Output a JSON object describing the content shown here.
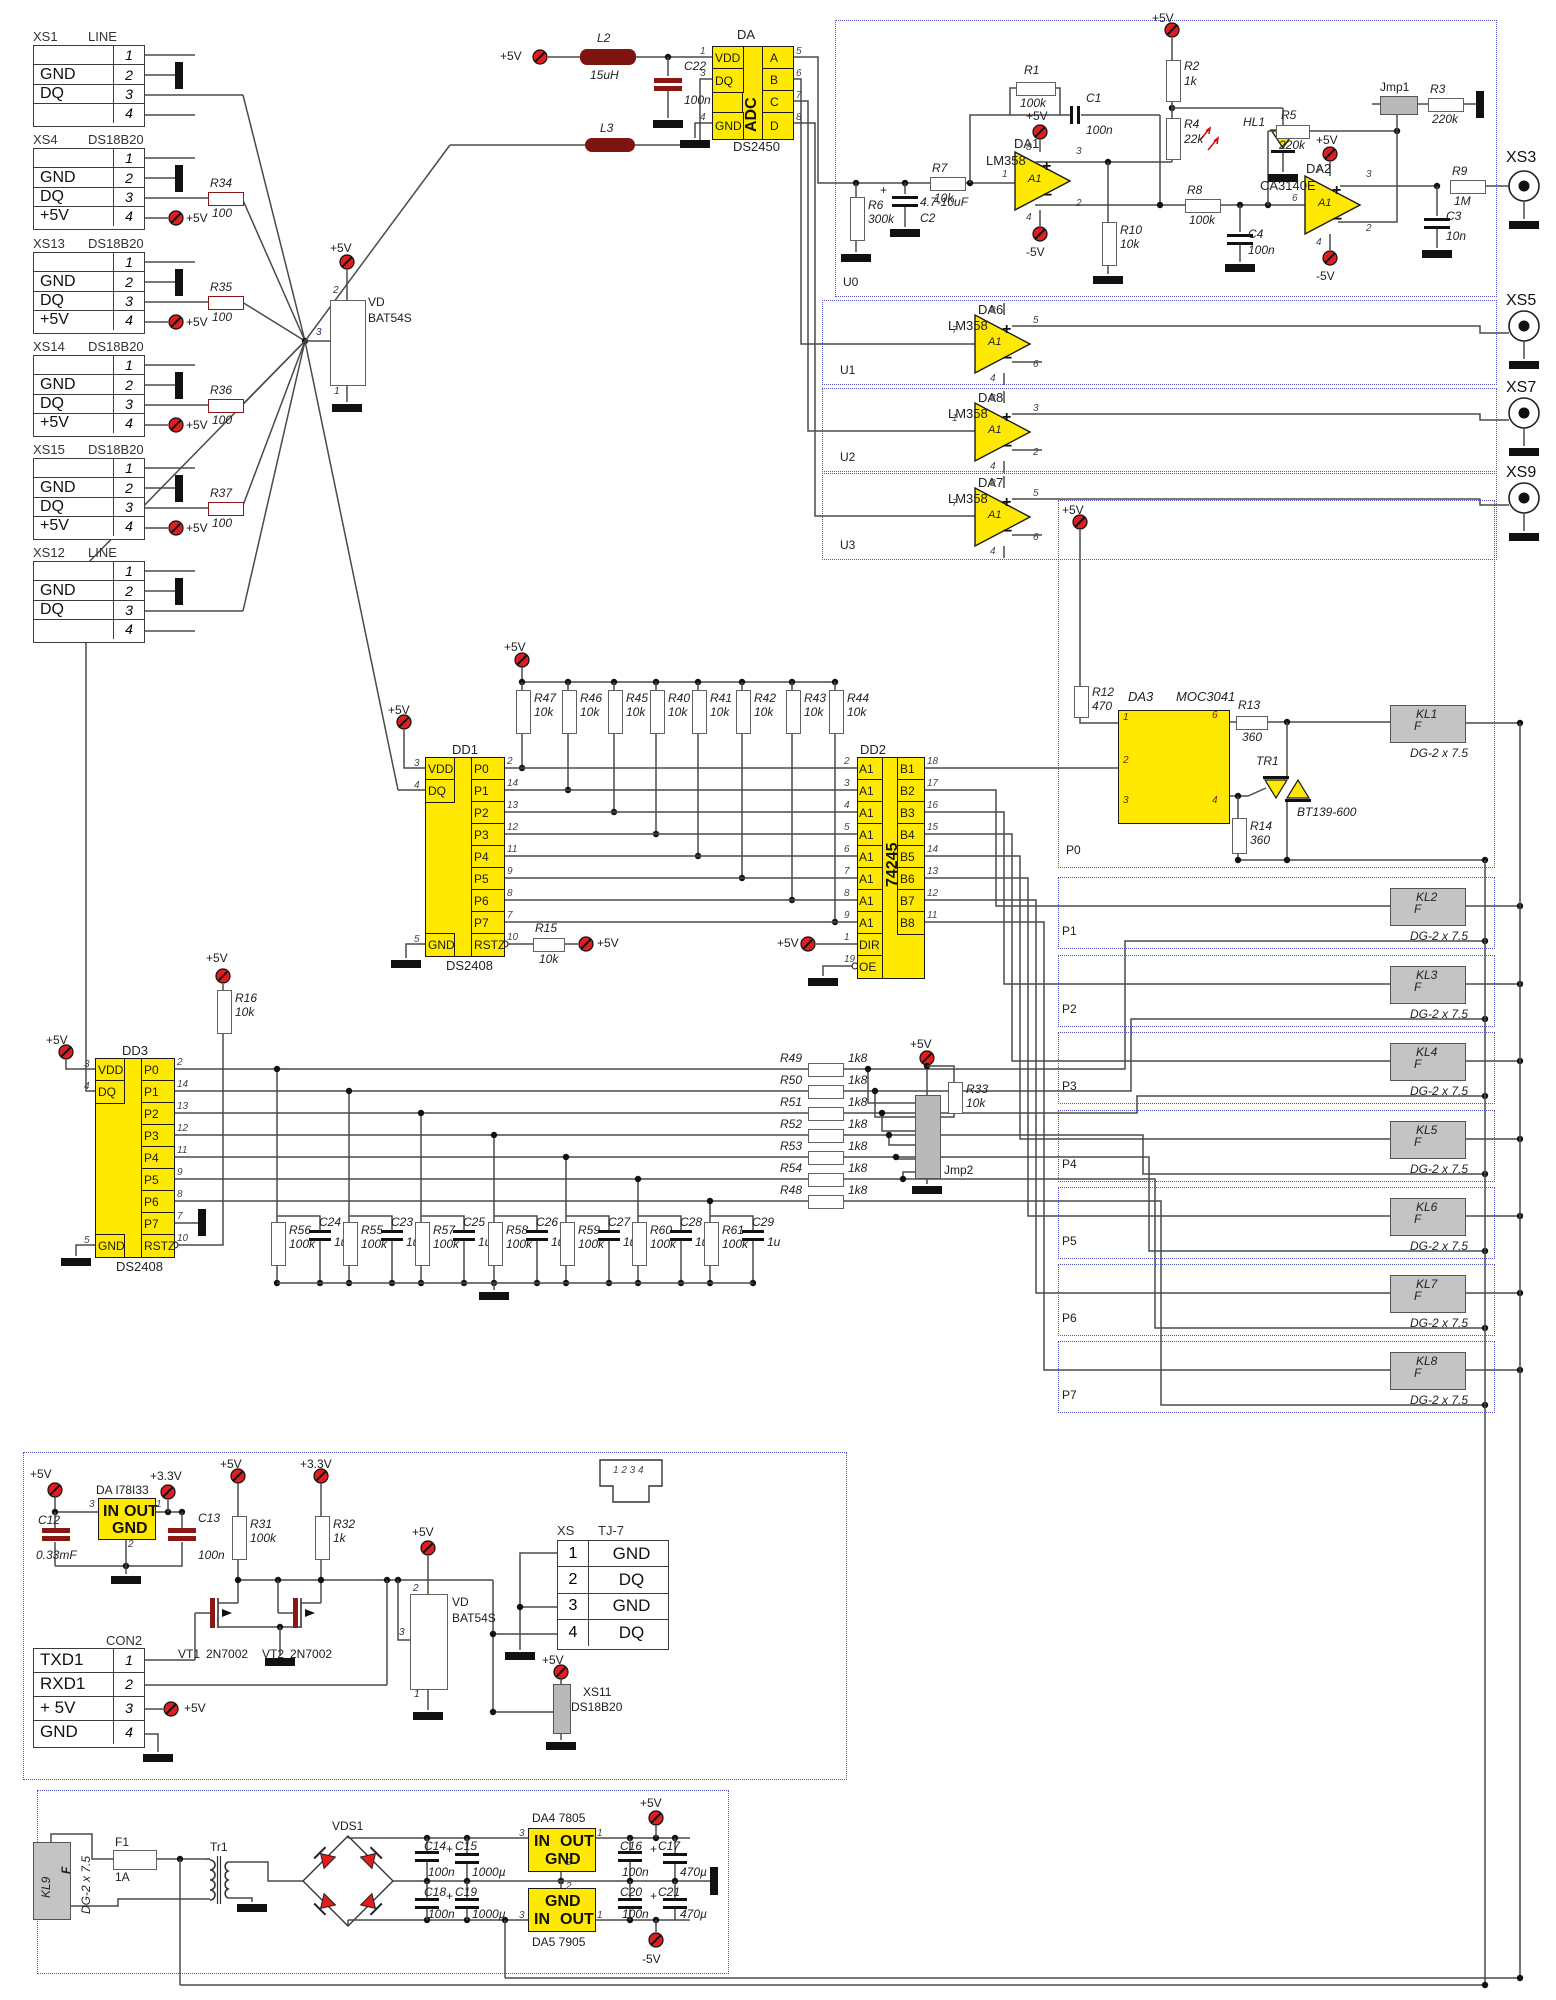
{
  "rails": {
    "p5": "+5V",
    "m5": "-5V",
    "p33": "+3.3V"
  },
  "plus": "+",
  "left_connectors": [
    {
      "title": "XS1",
      "sub": "LINE",
      "rows": [
        {
          "l": "",
          "p": "1"
        },
        {
          "l": "GND",
          "p": "2"
        },
        {
          "l": "DQ",
          "p": "3"
        },
        {
          "l": "",
          "p": "4"
        }
      ],
      "res": null
    },
    {
      "title": "XS4",
      "sub": "DS18B20",
      "rows": [
        {
          "l": "",
          "p": "1"
        },
        {
          "l": "GND",
          "p": "2"
        },
        {
          "l": "DQ",
          "p": "3"
        },
        {
          "l": "+5V",
          "p": "4"
        }
      ],
      "res": [
        "R34",
        "100"
      ]
    },
    {
      "title": "XS13",
      "sub": "DS18B20",
      "rows": [
        {
          "l": "",
          "p": "1"
        },
        {
          "l": "GND",
          "p": "2"
        },
        {
          "l": "DQ",
          "p": "3"
        },
        {
          "l": "+5V",
          "p": "4"
        }
      ],
      "res": [
        "R35",
        "100"
      ]
    },
    {
      "title": "XS14",
      "sub": "DS18B20",
      "rows": [
        {
          "l": "",
          "p": "1"
        },
        {
          "l": "GND",
          "p": "2"
        },
        {
          "l": "DQ",
          "p": "3"
        },
        {
          "l": "+5V",
          "p": "4"
        }
      ],
      "res": [
        "R36",
        "100"
      ]
    },
    {
      "title": "XS15",
      "sub": "DS18B20",
      "rows": [
        {
          "l": "",
          "p": "1"
        },
        {
          "l": "GND",
          "p": "2"
        },
        {
          "l": "DQ",
          "p": "3"
        },
        {
          "l": "+5V",
          "p": "4"
        }
      ],
      "res": [
        "R37",
        "100"
      ]
    },
    {
      "title": "XS12",
      "sub": "LINE",
      "rows": [
        {
          "l": "",
          "p": "1"
        },
        {
          "l": "GND",
          "p": "2"
        },
        {
          "l": "DQ",
          "p": "3"
        },
        {
          "l": "",
          "p": "4"
        }
      ],
      "res": null
    }
  ],
  "vd1": {
    "des": "VD",
    "part": "BAT54S",
    "p_top": "2",
    "p_mid": "3",
    "p_bot": "1"
  },
  "filter": {
    "l2": [
      "L2",
      "15uH"
    ],
    "c22": [
      "C22",
      "100n"
    ],
    "l3": [
      "L3"
    ]
  },
  "adc": {
    "title": "DA",
    "part": "DS2450",
    "core": "ADC",
    "left": [
      {
        "n": "VDD",
        "p": "1"
      },
      {
        "n": "DQ",
        "p": "3"
      },
      {
        "n": "GND",
        "p": "4"
      }
    ],
    "right": [
      {
        "n": "A",
        "p": "5"
      },
      {
        "n": "B",
        "p": "6"
      },
      {
        "n": "C",
        "p": "7"
      },
      {
        "n": "D",
        "p": "8"
      }
    ]
  },
  "u0": {
    "tag": "U0",
    "r6": [
      "R6",
      "300k"
    ],
    "c2": [
      "C2",
      "4.7-10uF"
    ],
    "r7": [
      "R7",
      "10k"
    ],
    "r1": [
      "R1",
      "100k"
    ],
    "c1": [
      "C1",
      "100n"
    ],
    "r2": [
      "R2",
      "1k"
    ],
    "r4": [
      "R4",
      "22k"
    ],
    "hl1": "HL1",
    "r10": [
      "R10",
      "10k"
    ],
    "r8": [
      "R8",
      "100k"
    ],
    "c4": [
      "C4",
      "100n"
    ],
    "r5": [
      "R5",
      "220k"
    ],
    "jmp1": "Jmp1",
    "r3": [
      "R3",
      "220k"
    ],
    "r9": [
      "R9",
      "1M"
    ],
    "c3": [
      "C3",
      "10n"
    ],
    "da1": {
      "d": "DA1",
      "t": "LM358",
      "core": "A1",
      "pins": {
        "top": "8",
        "left": "1",
        "bot": "4",
        "rt": "3",
        "rb": "2"
      }
    },
    "da2": {
      "d": "DA2",
      "t": "CA3140E",
      "core": "A1",
      "pins": {
        "top": "7",
        "left": "6",
        "bot": "4",
        "rt": "3",
        "rb": "2"
      }
    }
  },
  "u1": {
    "tag": "U1",
    "amp": {
      "d": "DA6",
      "t": "LM358",
      "core": "A1",
      "pins": {
        "top": "8",
        "left": "7",
        "bot": "4",
        "rt": "5",
        "rb": "6"
      }
    }
  },
  "u2": {
    "tag": "U2",
    "amp": {
      "d": "DA8",
      "t": "LM358",
      "core": "A1",
      "pins": {
        "top": "8",
        "left": "1",
        "bot": "4",
        "rt": "3",
        "rb": "2"
      }
    }
  },
  "u3": {
    "tag": "U3",
    "amp": {
      "d": "DA7",
      "t": "LM358",
      "core": "A1",
      "pins": {
        "top": "8",
        "left": "7",
        "bot": "4",
        "rt": "5",
        "rb": "6"
      }
    }
  },
  "jacks": {
    "xs3": "XS3",
    "xs5": "XS5",
    "xs7": "XS7",
    "xs9": "XS9"
  },
  "dd1": {
    "title": "DD1",
    "part": "DS2408",
    "left": [
      {
        "n": "VDD",
        "p": "3"
      },
      {
        "n": "DQ",
        "p": "4"
      },
      {
        "n": "GND",
        "p": "5"
      }
    ],
    "right": [
      {
        "n": "P0",
        "p": "2"
      },
      {
        "n": "P1",
        "p": "14"
      },
      {
        "n": "P2",
        "p": "13"
      },
      {
        "n": "P3",
        "p": "12"
      },
      {
        "n": "P4",
        "p": "11"
      },
      {
        "n": "P5",
        "p": "9"
      },
      {
        "n": "P6",
        "p": "8"
      },
      {
        "n": "P7",
        "p": "7"
      },
      {
        "n": "RSTZ",
        "p": "10"
      }
    ]
  },
  "dd2": {
    "title": "DD2",
    "part": "74245",
    "left": [
      {
        "n": "A1",
        "p": "2"
      },
      {
        "n": "A1",
        "p": "3"
      },
      {
        "n": "A1",
        "p": "4"
      },
      {
        "n": "A1",
        "p": "5"
      },
      {
        "n": "A1",
        "p": "6"
      },
      {
        "n": "A1",
        "p": "7"
      },
      {
        "n": "A1",
        "p": "8"
      },
      {
        "n": "A1",
        "p": "9"
      },
      {
        "n": "DIR",
        "p": "1"
      },
      {
        "n": "OE",
        "p": "19"
      }
    ],
    "right": [
      {
        "n": "B1",
        "p": "18"
      },
      {
        "n": "B2",
        "p": "17"
      },
      {
        "n": "B3",
        "p": "16"
      },
      {
        "n": "B4",
        "p": "15"
      },
      {
        "n": "B5",
        "p": "14"
      },
      {
        "n": "B6",
        "p": "13"
      },
      {
        "n": "B7",
        "p": "12"
      },
      {
        "n": "B8",
        "p": "11"
      }
    ]
  },
  "dd3": {
    "title": "DD3",
    "part": "DS2408",
    "left": [
      {
        "n": "VDD",
        "p": "3"
      },
      {
        "n": "DQ",
        "p": "4"
      },
      {
        "n": "GND",
        "p": "5"
      }
    ],
    "right": [
      {
        "n": "P0",
        "p": "2"
      },
      {
        "n": "P1",
        "p": "14"
      },
      {
        "n": "P2",
        "p": "13"
      },
      {
        "n": "P3",
        "p": "12"
      },
      {
        "n": "P4",
        "p": "11"
      },
      {
        "n": "P5",
        "p": "9"
      },
      {
        "n": "P6",
        "p": "8"
      },
      {
        "n": "P7",
        "p": "7"
      },
      {
        "n": "RSTZ",
        "p": "10"
      }
    ]
  },
  "pullups": [
    [
      "R47",
      "10k"
    ],
    [
      "R46",
      "10k"
    ],
    [
      "R45",
      "10k"
    ],
    [
      "R40",
      "10k"
    ],
    [
      "R41",
      "10k"
    ],
    [
      "R42",
      "10k"
    ],
    [
      "R43",
      "10k"
    ],
    [
      "R44",
      "10k"
    ]
  ],
  "r15": [
    "R15",
    "10k"
  ],
  "r16": [
    "R16",
    "10k"
  ],
  "r33": [
    "R33",
    "10k"
  ],
  "jmp2": "Jmp2",
  "drive": [
    [
      "R49",
      "1k8"
    ],
    [
      "R50",
      "1k8"
    ],
    [
      "R51",
      "1k8"
    ],
    [
      "R52",
      "1k8"
    ],
    [
      "R53",
      "1k8"
    ],
    [
      "R54",
      "1k8"
    ],
    [
      "R48",
      "1k8"
    ]
  ],
  "rc": [
    [
      "R56",
      "100k",
      "C24",
      "1u"
    ],
    [
      "R55",
      "100k",
      "C23",
      "1u"
    ],
    [
      "R57",
      "100k",
      "C25",
      "1u"
    ],
    [
      "R58",
      "100k",
      "C26",
      "1u"
    ],
    [
      "R59",
      "100k",
      "C27",
      "1u"
    ],
    [
      "R60",
      "100k",
      "C28",
      "1u"
    ],
    [
      "R61",
      "100k",
      "C29",
      "1u"
    ]
  ],
  "p0": {
    "tag": "P0",
    "r12": [
      "R12",
      "470"
    ],
    "da3": {
      "d": "DA3",
      "t": "MOC3041",
      "p1": "1",
      "p2": "2",
      "p3": "3",
      "p6": "6",
      "p4": "4"
    },
    "r13": [
      "R13",
      "360"
    ],
    "r14": [
      "R14",
      "360"
    ],
    "tr1": [
      "TR1",
      "BT139-600"
    ],
    "kl": [
      "KL1",
      "F",
      "DG-2 x 7.5"
    ]
  },
  "pboxes": [
    {
      "tag": "P1",
      "kl": [
        "KL2",
        "F",
        "DG-2 x 7.5"
      ]
    },
    {
      "tag": "P2",
      "kl": [
        "KL3",
        "F",
        "DG-2 x 7.5"
      ]
    },
    {
      "tag": "P3",
      "kl": [
        "KL4",
        "F",
        "DG-2 x 7.5"
      ]
    },
    {
      "tag": "P4",
      "kl": [
        "KL5",
        "F",
        "DG-2 x 7.5"
      ]
    },
    {
      "tag": "P5",
      "kl": [
        "KL6",
        "F",
        "DG-2 x 7.5"
      ]
    },
    {
      "tag": "P6",
      "kl": [
        "KL7",
        "F",
        "DG-2 x 7.5"
      ]
    },
    {
      "tag": "P7",
      "kl": [
        "KL8",
        "F",
        "DG-2 x 7.5"
      ]
    }
  ],
  "comm": {
    "reg": {
      "title": "DA  I78I33",
      "in": "IN",
      "out": "OUT",
      "gnd": "GND",
      "p3": "3",
      "p1": "1",
      "p2": "2"
    },
    "c12": [
      "C12",
      "0.33mF"
    ],
    "c13": [
      "C13",
      "100n"
    ],
    "r31": [
      "R31",
      "100k"
    ],
    "r32": [
      "R32",
      "1k"
    ],
    "vt1": [
      "VT1",
      "2N7002"
    ],
    "vt2": [
      "VT2",
      "2N7002"
    ],
    "vd2": {
      "des": "VD",
      "part": "BAT54S",
      "p_top": "2",
      "p_mid": "3",
      "p_bot": "1"
    },
    "con2": {
      "title": "CON2",
      "rows": [
        {
          "l": "TXD1",
          "p": "1"
        },
        {
          "l": "RXD1",
          "p": "2"
        },
        {
          "l": "+ 5V",
          "p": "3"
        },
        {
          "l": "GND",
          "p": "4"
        }
      ]
    },
    "tj7": {
      "t1": "XS",
      "t2": "TJ-7",
      "rjpins": "1 2 3 4",
      "rows": [
        {
          "p": "1",
          "l": "GND"
        },
        {
          "p": "2",
          "l": "DQ"
        },
        {
          "p": "3",
          "l": "GND"
        },
        {
          "p": "4",
          "l": "DQ"
        }
      ]
    },
    "xs11": {
      "title": "XS11",
      "part": "DS18B20"
    }
  },
  "psu": {
    "kl9": [
      "KL9",
      "F",
      "DG-2 x 7.5"
    ],
    "f1": [
      "F1",
      "1A"
    ],
    "tr1": "Tr1",
    "vds1": "VDS1",
    "c14": [
      "C14",
      "100n"
    ],
    "c15": [
      "C15",
      "1000µ"
    ],
    "c16": [
      "C16",
      "100n"
    ],
    "c17": [
      "C17",
      "470µ"
    ],
    "c18": [
      "C18",
      "100n"
    ],
    "c19": [
      "C19",
      "1000µ"
    ],
    "c20": [
      "C20",
      "100n"
    ],
    "c21": [
      "C21",
      "470µ"
    ],
    "da4": {
      "title": "DA4  7805",
      "in": "IN",
      "out": "OUT",
      "gnd": "GND",
      "p3": "3",
      "p1": "1",
      "p2": "2"
    },
    "da5": {
      "title": "DA5  7905",
      "in": "IN",
      "out": "OUT",
      "gnd": "GND",
      "p3": "3",
      "p1": "1",
      "p2": "2"
    }
  }
}
